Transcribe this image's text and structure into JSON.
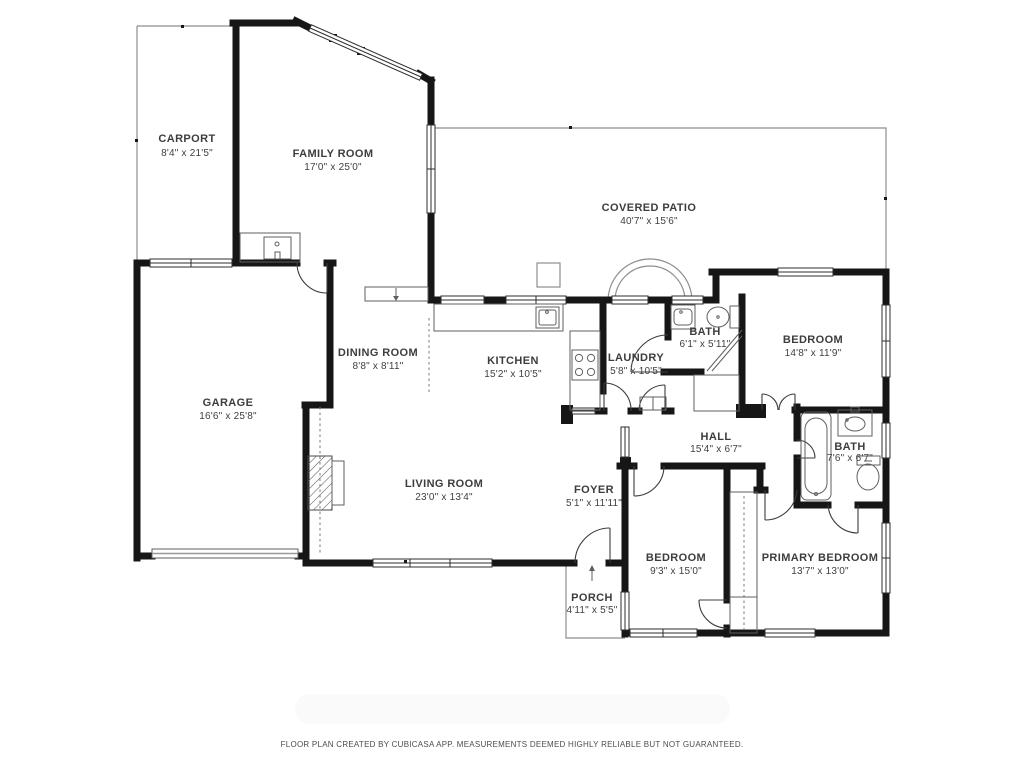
{
  "page": {
    "background": "#ffffff",
    "wall_color": "#161616",
    "outline_color": "#8e8e8e",
    "label_color": "#3d3d3d"
  },
  "rooms": [
    {
      "id": "carport",
      "name": "CARPORT",
      "dims": "8'4\" x 21'5\""
    },
    {
      "id": "family-room",
      "name": "FAMILY ROOM",
      "dims": "17'0\" x 25'0\""
    },
    {
      "id": "covered-patio",
      "name": "COVERED PATIO",
      "dims": "40'7\" x 15'6\""
    },
    {
      "id": "garage",
      "name": "GARAGE",
      "dims": "16'6\" x 25'8\""
    },
    {
      "id": "dining-room",
      "name": "DINING ROOM",
      "dims": "8'8\" x 8'11\""
    },
    {
      "id": "kitchen",
      "name": "KITCHEN",
      "dims": "15'2\" x 10'5\""
    },
    {
      "id": "laundry",
      "name": "LAUNDRY",
      "dims": "5'8\" x 10'5\""
    },
    {
      "id": "bath-upper",
      "name": "BATH",
      "dims": "6'1\" x 5'11\""
    },
    {
      "id": "bedroom-right",
      "name": "BEDROOM",
      "dims": "14'8\" x 11'9\""
    },
    {
      "id": "hall",
      "name": "HALL",
      "dims": "15'4\" x 6'7\""
    },
    {
      "id": "bath-lower",
      "name": "BATH",
      "dims": "7'6\" x 6'7\""
    },
    {
      "id": "living-room",
      "name": "LIVING ROOM",
      "dims": "23'0\" x 13'4\""
    },
    {
      "id": "foyer",
      "name": "FOYER",
      "dims": "5'1\" x 11'11\""
    },
    {
      "id": "bedroom-bottom",
      "name": "BEDROOM",
      "dims": "9'3\" x 15'0\""
    },
    {
      "id": "primary-bedroom",
      "name": "PRIMARY BEDROOM",
      "dims": "13'7\" x 13'0\""
    },
    {
      "id": "porch",
      "name": "PORCH",
      "dims": "4'11\" x 5'5\""
    }
  ],
  "footer": {
    "disclaimer": "FLOOR PLAN CREATED BY CUBICASA APP. MEASUREMENTS DEEMED HIGHLY RELIABLE BUT NOT GUARANTEED."
  }
}
